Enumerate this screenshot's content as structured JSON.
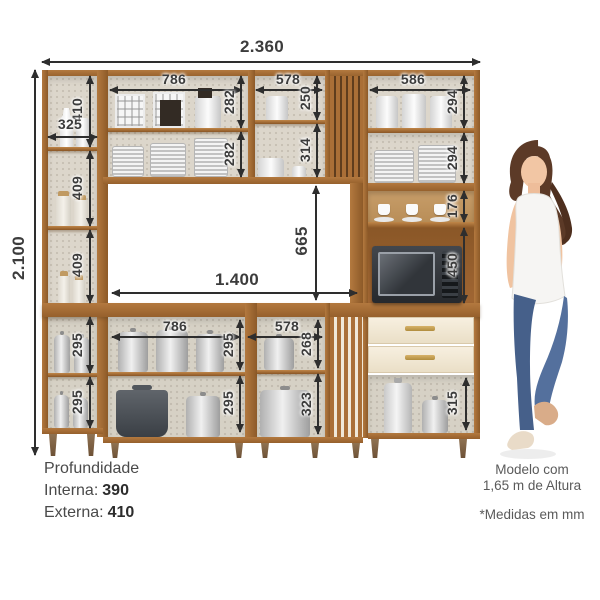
{
  "diagram": {
    "dims": {
      "total_width": "2.360",
      "total_height": "2.100",
      "left_col": {
        "top_height": "410",
        "top_inner_width": "325",
        "mid1_height": "409",
        "mid2_height": "409",
        "low1_height": "295",
        "low2_height": "295"
      },
      "upper_center": {
        "width": "786",
        "sec1_height": "282",
        "sec2_height": "282"
      },
      "upper_mid": {
        "width": "578",
        "sec1_height": "250",
        "sec2_height": "314"
      },
      "hutch": {
        "width": "586",
        "sec1_height": "294",
        "sec2_height": "294",
        "sec3_height": "176",
        "niche_height": "450"
      },
      "open_space": {
        "width": "1.400",
        "height": "665"
      },
      "lower_center": {
        "width": "786",
        "sec1_height": "295",
        "sec2_height": "295"
      },
      "lower_mid": {
        "width": "578",
        "sec1_height": "268",
        "sec2_height": "323"
      },
      "drawer_unit": {
        "shelf_height": "315"
      }
    },
    "notes": {
      "depth_title": "Profundidade",
      "depth_internal_label": "Interna:",
      "depth_internal_value": "390",
      "depth_external_label": "Externa:",
      "depth_external_value": "410",
      "model_note_line1": "Modelo com",
      "model_note_line2": "1,65 m de Altura",
      "units_note": "*Medidas em mm"
    },
    "colors": {
      "wood": "#a4672f",
      "wood_dark": "#7c4c1e",
      "interior": "#dcd6cb",
      "drawer_front": "#f4ecdb",
      "handle_gold": "#c6a052",
      "dimension_text": "#3c3c3c",
      "background": "#ffffff"
    }
  }
}
